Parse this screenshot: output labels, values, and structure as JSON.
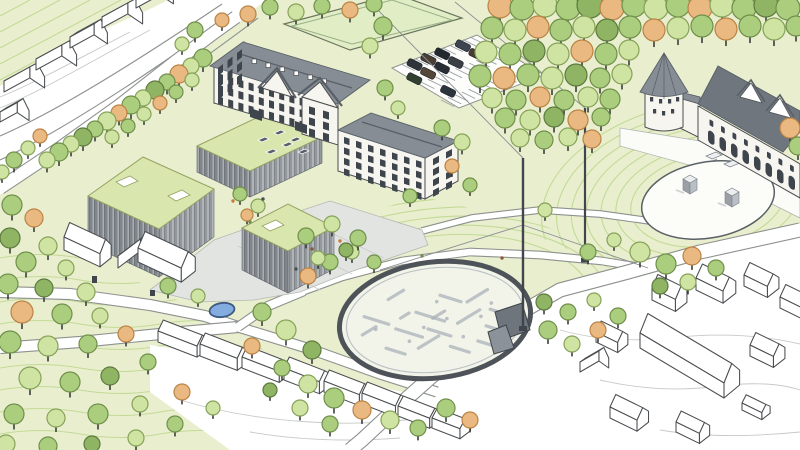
{
  "meta": {
    "kind": "architectural-site-plan-illustration",
    "view": "aerial isometric hand-drawn rendering",
    "canvas": {
      "width": 800,
      "height": 450
    }
  },
  "titles": {
    "scene": "Aerial site-plan illustration of a school campus with park, oval festival ground and heritage buildings",
    "lawn": "Lawn and meadow areas",
    "park": "Park with scattered trees",
    "roads": "Roads and footpaths",
    "field": "Sports field",
    "parking": "Parking lot with parked cars",
    "plaza": "Paved campus forecourt with tree grid",
    "oval": "Oval festival ground with archaeological ground markings",
    "pavilion": "Angular stage pavilion at the oval",
    "memorial": "Oval memorial garden with standing stones",
    "terrace": "Heritage forecourt terrace with stairs",
    "pond": "Small round pond",
    "campus": "New campus buildings with green roofs",
    "courtyard": "Planted inner courtyard",
    "h1": "Historic main school building",
    "h2": "Historic annex building",
    "h3": "Heritage hall with round tower",
    "context": "Surrounding context buildings (outline sketch)",
    "masts": "Masts with guy cables",
    "trees": "Trees (green and autumn-coloured)",
    "figures": "People in the open spaces"
  },
  "scene": {
    "palette": {
      "background": "#ffffff",
      "lawn": "#e9efce",
      "lawn_hatch": "#c3da96",
      "field": "#e1edc5",
      "field_edge": "#6b7560",
      "road_edge": "#8d928e",
      "plaza": "#e2e4e2",
      "plaza_edge": "#b4b8b4",
      "oval_ring": "#4d5358",
      "oval_fill": "#f2f4e9",
      "ruin": "#aab2b9",
      "pavilion_dark": "#6e757c",
      "pavilion_mid": "#8b9299",
      "modern_roof": "#d9e7ae",
      "modern_roof_edge": "#94a363",
      "modern_facade": "#7f858a",
      "modern_facade_light": "#92989c",
      "stripe_light": "#b4b9bc",
      "stripe_dark": "#686e73",
      "stripe_light2": "#c3c7ca",
      "stripe_dark2": "#7b8186",
      "historic_wall": "#f7f5ef",
      "historic_roof": "#868d95",
      "historic_roof_dark": "#6f767e",
      "roof_line": "#585f66",
      "window": "#3f454c",
      "sketch": "#4b4e51",
      "contour": "#c6cac5",
      "pond": "#83ade0",
      "pond_edge": "#3e5a82",
      "trunk": "#2e322f",
      "mast": "#41464c",
      "cable": "#8b9095",
      "stone_top": "#eceef0",
      "stone_side": "#9aa0a6"
    },
    "tree_variants": {
      "l": {
        "fill": "#cfe3a2",
        "stroke": "#86a258"
      },
      "m": {
        "fill": "#abce7e",
        "stroke": "#6f8f4a"
      },
      "d": {
        "fill": "#8fb464",
        "stroke": "#5d7a3e"
      },
      "v": {
        "fill": "#bccf83",
        "stroke": "#7d8c4d"
      },
      "o": {
        "fill": "#e9b981",
        "stroke": "#bb8345"
      },
      "p": {
        "fill": "#f0d2a6",
        "stroke": "#c49a62"
      }
    },
    "cars": {
      "colors": [
        "#2f343a",
        "#4a3e33",
        "#23282e",
        "#3d4551",
        "#31402f",
        "#55463a",
        "#282d33",
        "#3a4046",
        "#473c2f",
        "#2c343d",
        "#363c42"
      ]
    },
    "figure_colors": [
      "#c97a3e",
      "#4a4f54",
      "#6f8f4a",
      "#8a5a3a"
    ]
  }
}
